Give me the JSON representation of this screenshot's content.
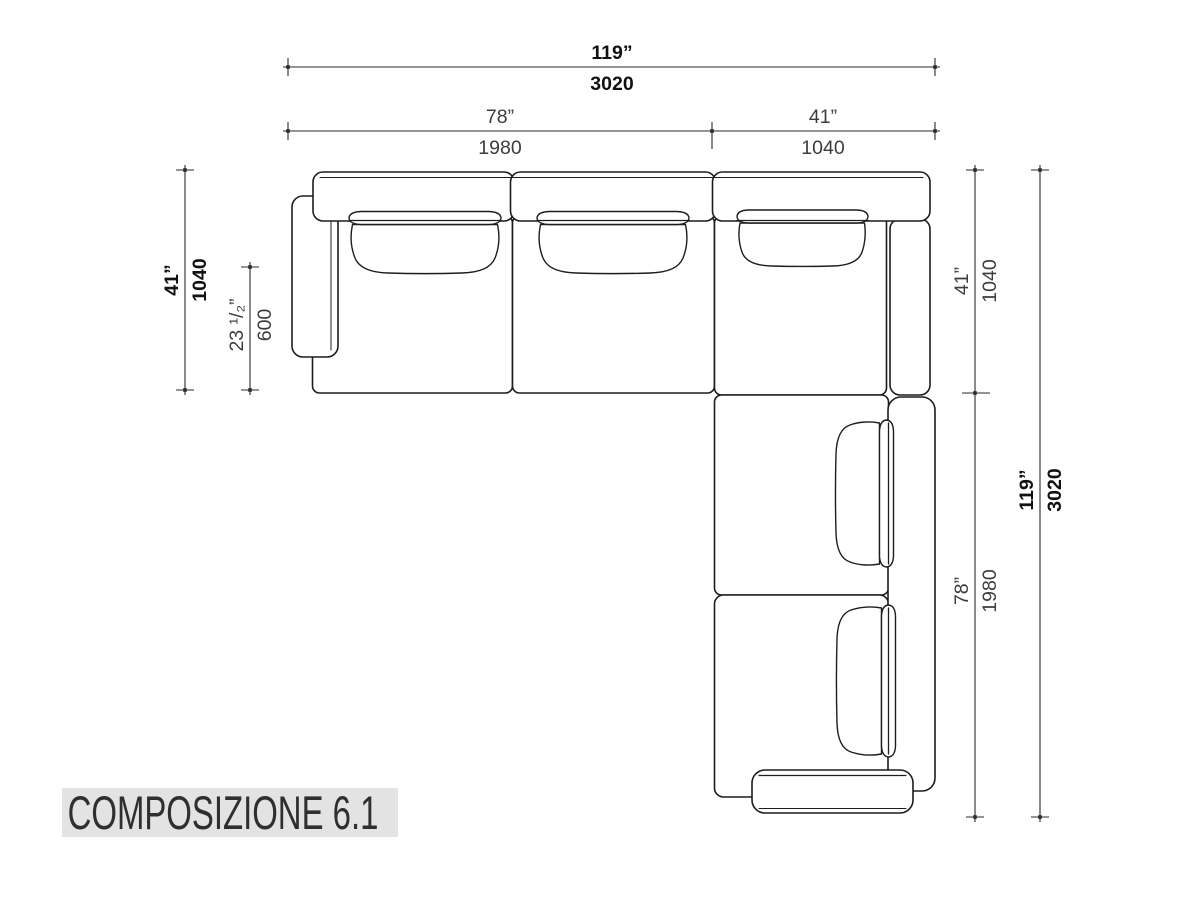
{
  "title": {
    "label": "COMPOSIZIONE 6.1"
  },
  "colors": {
    "ink": "#1d1d1d",
    "dim_line": "#2b2b2b",
    "dim_text_regular": "#3c3c3c",
    "dim_text_bold": "#111111",
    "title_bg": "#e3e3e3",
    "title_text": "#2f2f2f"
  },
  "dimensions": [
    {
      "id": "overall-width",
      "inches": "119”",
      "mm": "3020",
      "emphasis": "bold"
    },
    {
      "id": "left-section-width",
      "inches": "78”",
      "mm": "1980",
      "emphasis": "regular"
    },
    {
      "id": "corner-width",
      "inches": "41”",
      "mm": "1040",
      "emphasis": "regular"
    },
    {
      "id": "left-depth",
      "inches": "41”",
      "mm": "1040",
      "emphasis": "bold"
    },
    {
      "id": "seat-depth",
      "inches": "23 ¹/₂”",
      "mm": "600",
      "emphasis": "regular"
    },
    {
      "id": "right-corner-depth",
      "inches": "41”",
      "mm": "1040",
      "emphasis": "regular"
    },
    {
      "id": "right-section-length",
      "inches": "78”",
      "mm": "1980",
      "emphasis": "regular"
    },
    {
      "id": "overall-height",
      "inches": "119”",
      "mm": "3020",
      "emphasis": "bold"
    }
  ]
}
